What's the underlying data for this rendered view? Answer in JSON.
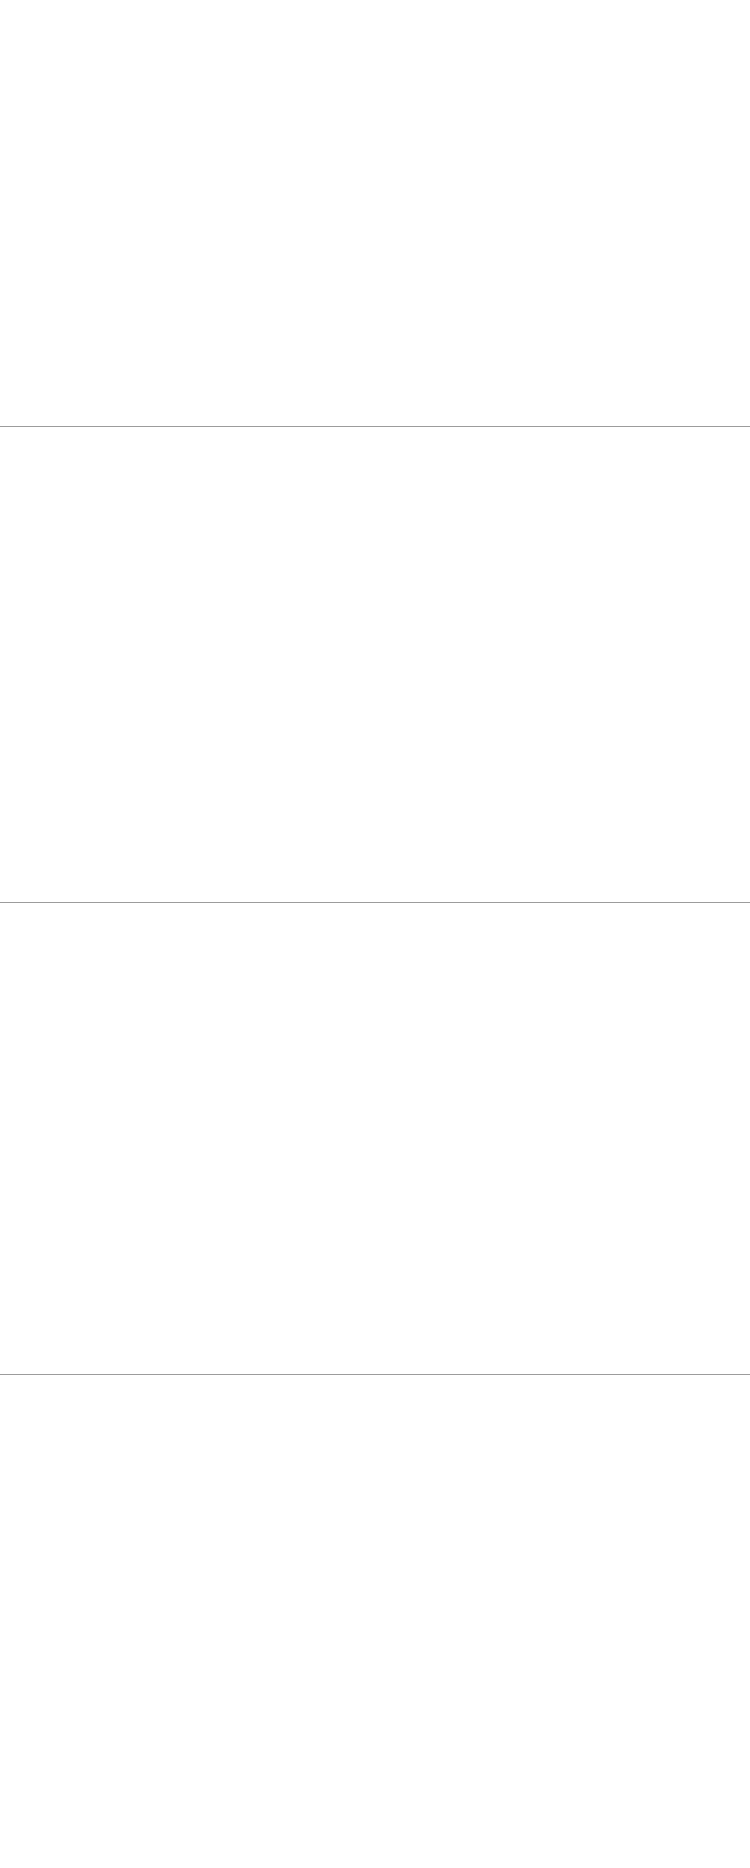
{
  "title": {
    "en": "Alcove",
    "zh": "凹形沙发"
  },
  "watermark": "www.ansuner.com",
  "sections": [
    {
      "models": [
        {
          "key": "a1507-a",
          "name": "A1507(A 款矮背单位 )",
          "size": "尺寸：860W×860D×850H",
          "x": 30,
          "y": 28,
          "h": 92,
          "views": [
            {
              "t": "dim",
              "label": "850",
              "tf": true
            },
            {
              "t": "draw",
              "k": "sideLow",
              "w": 82,
              "hdim": "860"
            },
            {
              "t": "gap",
              "w": 44
            },
            {
              "t": "dim",
              "label": "850",
              "tf": true
            },
            {
              "t": "draw",
              "k": "frontLow",
              "n": 1,
              "w": 86,
              "hdim": "860"
            },
            {
              "t": "dim",
              "label": "400",
              "frac": 0.47,
              "tf": true
            }
          ]
        },
        {
          "key": "a1507-b",
          "name": "A1507(B 款矮背双位 )",
          "size": "尺寸：1575W×860D×850H",
          "x": 420,
          "y": 34,
          "h": 84,
          "views": [
            {
              "t": "draw",
              "k": "sideLow",
              "w": 86,
              "hdim": "860"
            },
            {
              "t": "dim",
              "label": "850H",
              "tf": true
            },
            {
              "t": "gap",
              "w": 22
            },
            {
              "t": "draw",
              "k": "frontLow",
              "n": 2,
              "w": 158,
              "hdim": "1575"
            },
            {
              "t": "dim",
              "label": "400",
              "frac": 0.47,
              "tf": true
            }
          ]
        },
        {
          "key": "a1507-c",
          "name": "A1507(C 款矮背三位 )",
          "size": "尺寸：2530W×860D×850H",
          "x": 14,
          "y": 226,
          "h": 90,
          "views": [
            {
              "t": "dim",
              "label": "850",
              "tf": true
            },
            {
              "t": "draw",
              "k": "sideLow",
              "w": 72,
              "hdim": "860"
            },
            {
              "t": "gap",
              "w": 8
            },
            {
              "t": "dim",
              "label": "850",
              "tf": true
            },
            {
              "t": "draw",
              "k": "frontLow",
              "n": 3,
              "w": 166,
              "hdim": "2530"
            },
            {
              "t": "dim",
              "label": "400",
              "frac": 0.47,
              "tf": true
            }
          ]
        },
        {
          "key": "a1507-d",
          "name": "A1507(D 款脚踏 )",
          "size": "尺寸：750W×750D×400H",
          "x": 440,
          "y": 270,
          "h": 46,
          "views": [
            {
              "t": "dim",
              "label": "400",
              "tf": true
            },
            {
              "t": "draw",
              "k": "ottoman",
              "w": 78,
              "hdim": "750"
            },
            {
              "t": "gap",
              "w": 10
            },
            {
              "t": "draw",
              "k": "ottoman",
              "w": 78,
              "hdim": "750"
            }
          ]
        }
      ]
    },
    {
      "models": [
        {
          "key": "a1507-1-a",
          "name": "A1507-1(A 款中背单位 )",
          "size": "尺寸：1265W×860D×940H",
          "x": 40,
          "y": 42,
          "h": 114,
          "views": [
            {
              "t": "dim",
              "label": "940",
              "tf": true
            },
            {
              "t": "draw",
              "k": "front",
              "p": "m",
              "n": 1,
              "w": 130,
              "hdim": "1265"
            },
            {
              "t": "dim",
              "label": "485",
              "frac": 0.52,
              "tf": false
            },
            {
              "t": "gap",
              "w": 14
            },
            {
              "t": "dim",
              "label": "940",
              "tf": true
            },
            {
              "t": "draw",
              "k": "side",
              "p": "m",
              "w": 62,
              "hdim": "860"
            }
          ]
        },
        {
          "key": "a1507-1-b",
          "name": "A1507-1(B 款中背双位 )",
          "size": "尺寸：1600W×860D×940H",
          "x": 412,
          "y": 48,
          "h": 108,
          "views": [
            {
              "t": "draw",
              "k": "front",
              "p": "m",
              "n": 2,
              "w": 156,
              "hdim": "1640"
            },
            {
              "t": "dim",
              "label": "940",
              "tf": false
            },
            {
              "t": "gap",
              "w": 20
            },
            {
              "t": "draw",
              "k": "side",
              "p": "m",
              "w": 80,
              "hdim": "860"
            },
            {
              "t": "dim",
              "label": "940",
              "tf": false
            }
          ]
        },
        {
          "key": "a1507-1-c",
          "name": "A1507-1(C 款中背三位 )",
          "size": "尺寸：2370W×860D×940H",
          "x": 26,
          "y": 250,
          "h": 114,
          "views": [
            {
              "t": "draw",
              "k": "front",
              "p": "m",
              "n": 3,
              "w": 252,
              "hdim": "2370"
            },
            {
              "t": "dim",
              "label": "940",
              "tf": false
            },
            {
              "t": "gap",
              "w": 22
            },
            {
              "t": "draw",
              "k": "side",
              "p": "m",
              "w": 82,
              "hdim": "860"
            },
            {
              "t": "dim",
              "label": "940",
              "tf": false
            }
          ]
        }
      ]
    },
    {
      "models": [
        {
          "key": "a1507-2-a",
          "name": "A1507-2(A 款高背单位 )",
          "size": "尺寸：1265W×860D×1360H",
          "x": 46,
          "y": 50,
          "h": 112,
          "views": [
            {
              "t": "dim",
              "label": "1360",
              "tf": true
            },
            {
              "t": "draw",
              "k": "front",
              "p": "h",
              "n": 1,
              "w": 102,
              "hdim": "1265"
            },
            {
              "t": "dim",
              "label": "485",
              "frac": 0.36,
              "tf": false
            },
            {
              "t": "gap",
              "w": 12
            },
            {
              "t": "dim",
              "label": "1360",
              "tf": true
            },
            {
              "t": "draw",
              "k": "side",
              "p": "h",
              "w": 66,
              "hdim": "860"
            }
          ]
        },
        {
          "key": "a1507-2-b",
          "name": "A1507-2(B 款中背双位 )",
          "size": "尺寸：1620W×860D×1360H",
          "x": 405,
          "y": 50,
          "h": 112,
          "views": [
            {
              "t": "dim",
              "label": "1360",
              "tf": true
            },
            {
              "t": "draw",
              "k": "front",
              "p": "h",
              "n": 2,
              "w": 126,
              "hdim": "1620"
            },
            {
              "t": "dim",
              "label": "385",
              "frac": 0.29,
              "tf": false
            },
            {
              "t": "dim",
              "label": "1360",
              "tf": false
            },
            {
              "t": "gap",
              "w": 6
            },
            {
              "t": "draw",
              "k": "side",
              "p": "h",
              "w": 78,
              "hdim": "860"
            },
            {
              "t": "dim",
              "label": "1360",
              "tf": false
            }
          ]
        },
        {
          "key": "a1507-2-c",
          "name": "A1507-2(C 款高背三位 )",
          "size": "尺寸：2380W×860D×1360H",
          "x": 26,
          "y": 258,
          "h": 110,
          "views": [
            {
              "t": "dim",
              "label": "1360",
              "tf": true
            },
            {
              "t": "draw",
              "k": "front",
              "p": "h",
              "n": 3,
              "w": 186,
              "hdim": "2380"
            },
            {
              "t": "dim",
              "label": "385",
              "frac": 0.29,
              "tf": false
            },
            {
              "t": "gap",
              "w": 4
            },
            {
              "t": "dim",
              "label": "1360",
              "tf": true
            },
            {
              "t": "draw",
              "k": "side",
              "p": "h",
              "w": 70,
              "hdim": "860"
            }
          ]
        }
      ]
    },
    {
      "models": [
        {
          "key": "a1507-3-a",
          "name": "A1507-3(A 款特高背单位 )",
          "size": "尺寸：1265W×860D×1870H",
          "x": 26,
          "y": 44,
          "h": 126,
          "views": [
            {
              "t": "dim",
              "label": "1870",
              "tf": true
            },
            {
              "t": "draw",
              "k": "front",
              "p": "x",
              "n": 1,
              "w": 84,
              "hdim": "1265"
            },
            {
              "t": "dim",
              "label": "480",
              "frac": 0.26,
              "tf": false
            },
            {
              "t": "gap",
              "w": 8
            },
            {
              "t": "dim",
              "label": "1870",
              "tf": true
            },
            {
              "t": "draw",
              "k": "side",
              "p": "x",
              "w": 56,
              "hdim": "860"
            }
          ]
        },
        {
          "key": "a1507-3-b",
          "name": "A1507-3(B 款特高背双位 )",
          "size": "尺寸：1620W×860D×1870H",
          "x": 404,
          "y": 44,
          "h": 128,
          "views": [
            {
              "t": "dim",
              "label": "1870",
              "tf": true
            },
            {
              "t": "draw",
              "k": "front",
              "p": "x",
              "n": 2,
              "w": 112,
              "hdim": "1620"
            },
            {
              "t": "dim",
              "label": "480",
              "frac": 0.26,
              "tf": false
            },
            {
              "t": "dim",
              "label": "1870",
              "tf": false
            },
            {
              "t": "gap",
              "w": 6
            },
            {
              "t": "draw",
              "k": "side",
              "p": "x",
              "w": 62,
              "hdim": "860"
            },
            {
              "t": "dim",
              "label": "1870",
              "tf": false
            }
          ]
        },
        {
          "key": "a1507-3-c",
          "name": "A1507-3(C 款特高背三位 )",
          "size": "尺寸：2380W×860D×1870H",
          "x": 26,
          "y": 268,
          "h": 126,
          "views": [
            {
              "t": "dim",
              "label": "1870",
              "tf": true
            },
            {
              "t": "draw",
              "k": "front",
              "p": "x",
              "n": 3,
              "w": 168,
              "hdim": "2380"
            },
            {
              "t": "dim",
              "label": "480",
              "frac": 0.26,
              "tf": false
            },
            {
              "t": "gap",
              "w": 4
            },
            {
              "t": "dim",
              "label": "1870",
              "tf": true
            },
            {
              "t": "draw",
              "k": "side",
              "p": "x",
              "w": 56,
              "hdim": "860"
            }
          ]
        }
      ]
    }
  ]
}
